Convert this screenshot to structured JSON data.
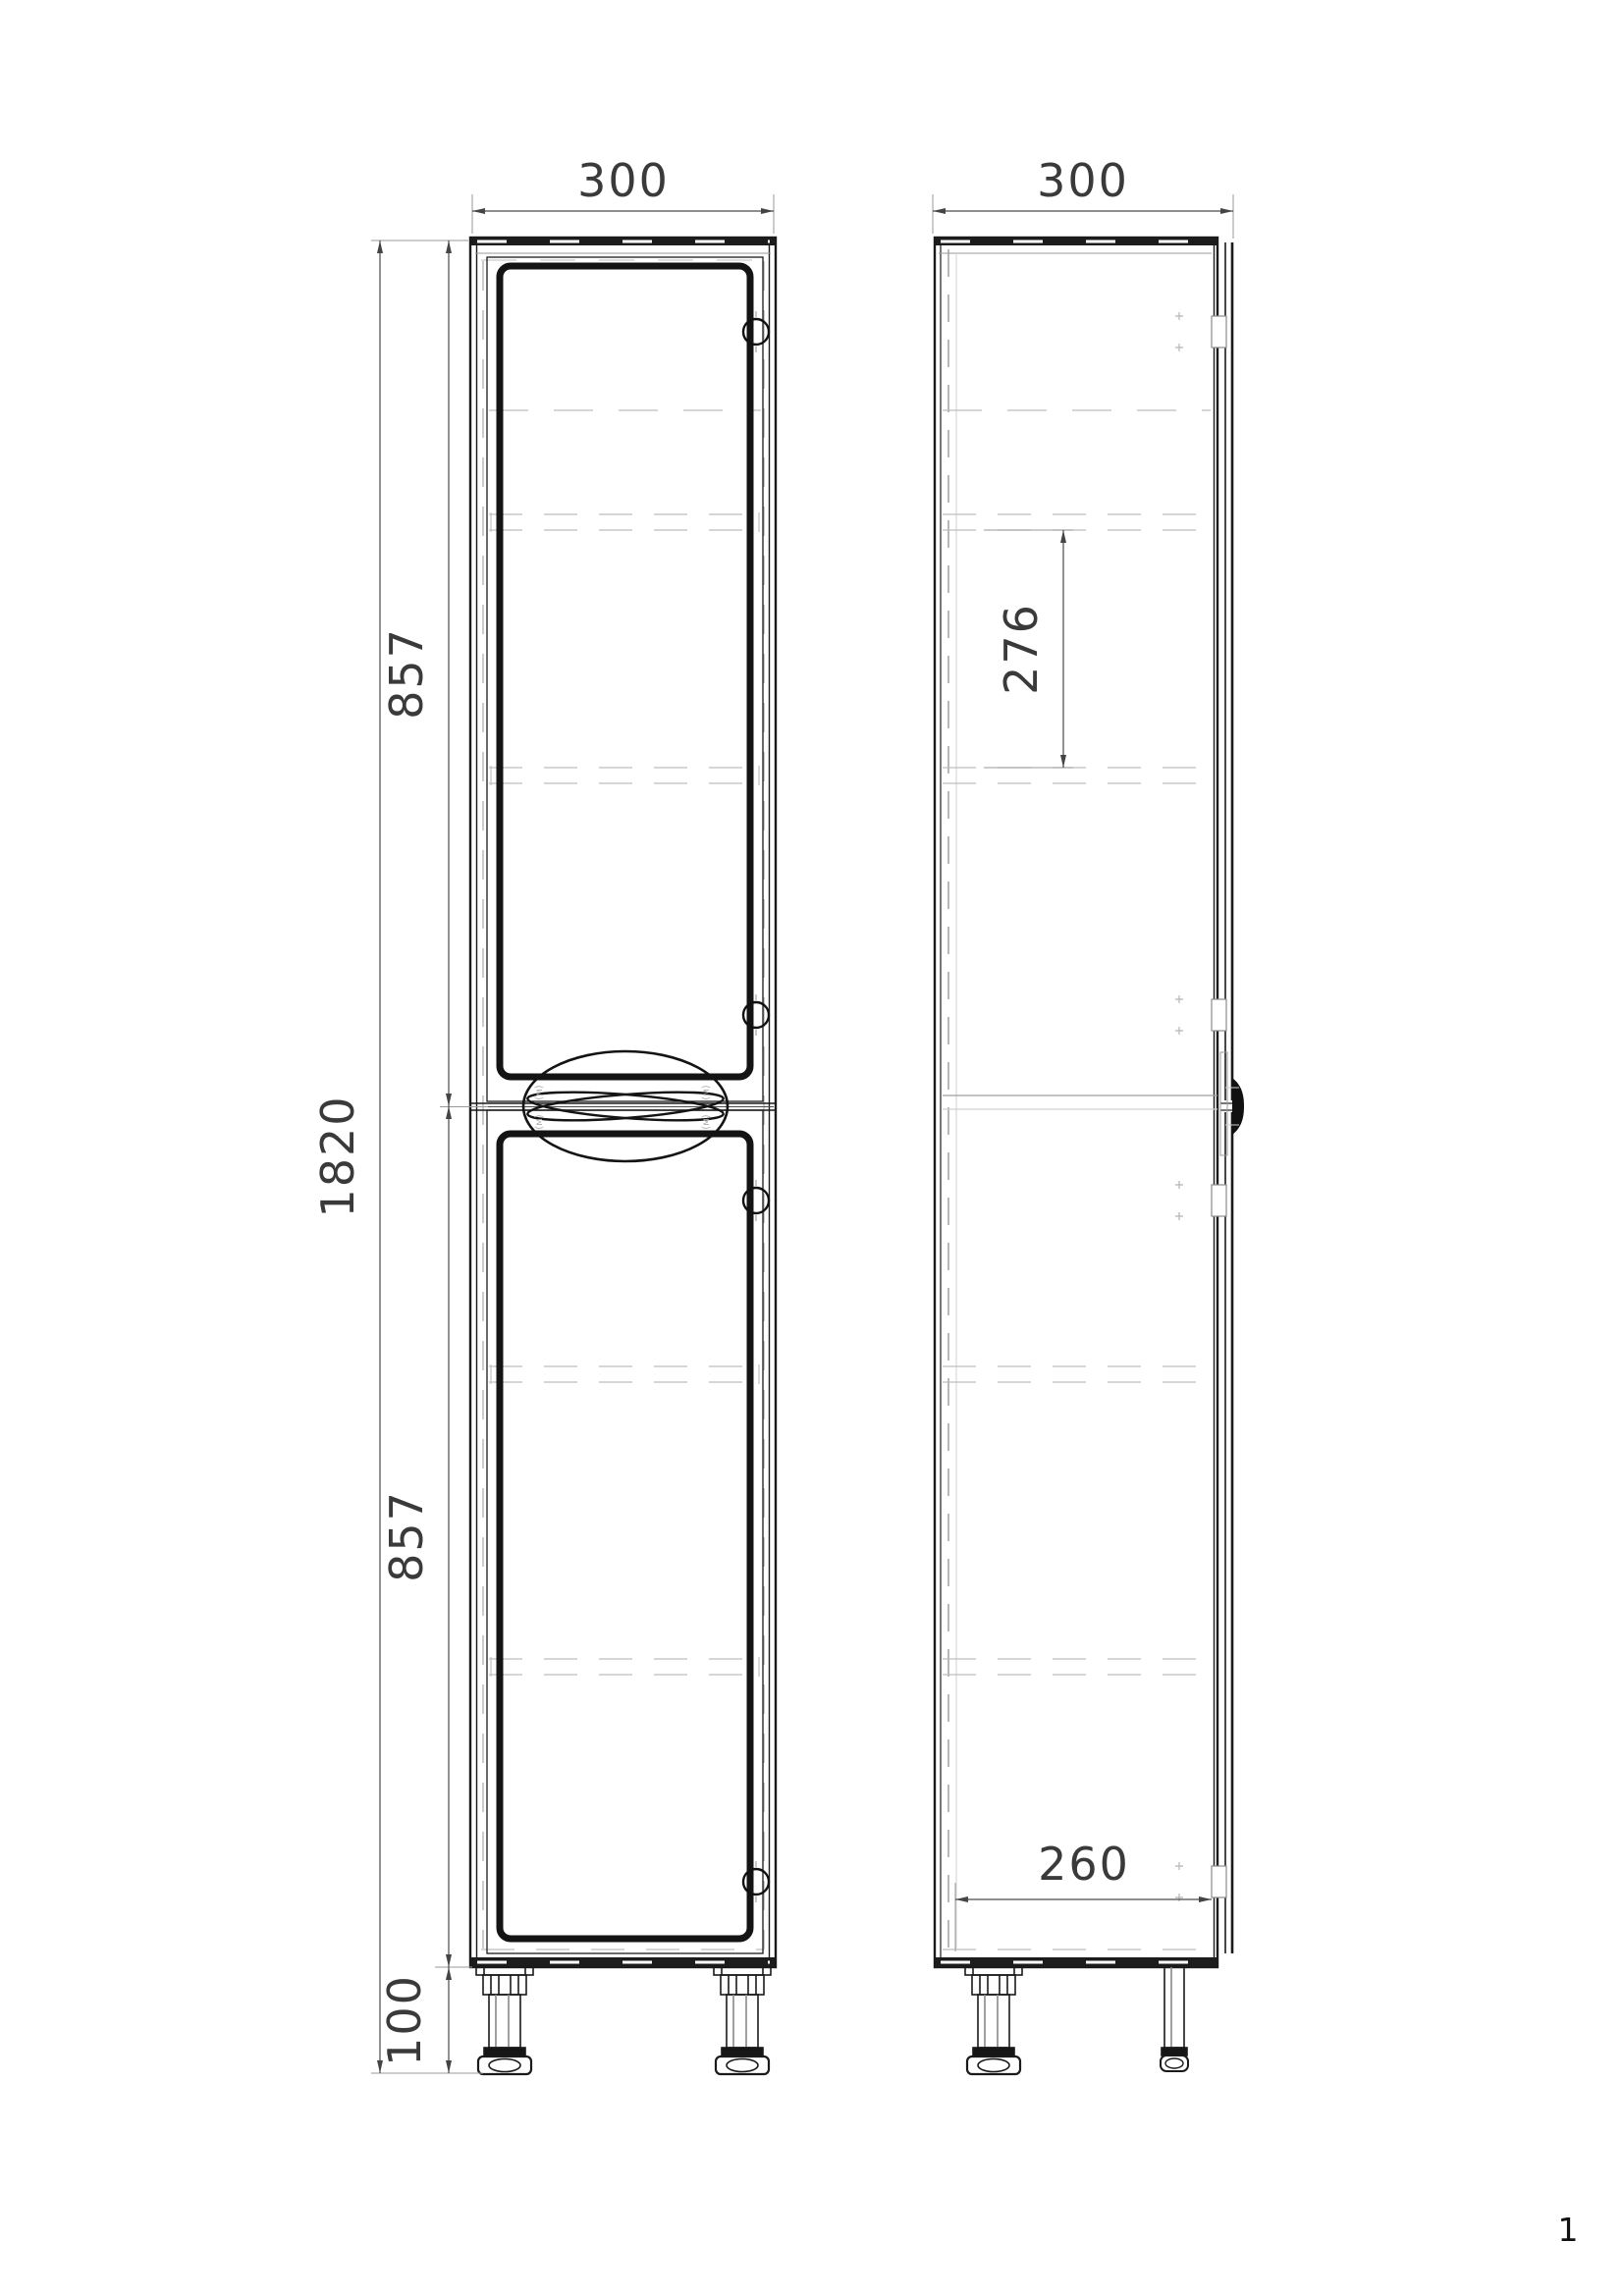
{
  "dimensions": {
    "front_width": "300",
    "side_depth": "300",
    "total_height": "1820",
    "upper_section_height": "857",
    "lower_section_height": "857",
    "leg_height": "100",
    "shelf_spacing": "276",
    "interior_depth": "260"
  },
  "handle_marks": {
    "m1": "(м)",
    "m2": "(м)",
    "m3": "(м)",
    "m4": "(м)"
  },
  "page_number": "1",
  "colors": {
    "line": "#1a1a1a",
    "dim_line": "#4a4a4a",
    "ext_line": "#9a9a9a",
    "hidden_line": "#bdbdbd",
    "text": "#3a3a3a",
    "background": "#ffffff"
  }
}
